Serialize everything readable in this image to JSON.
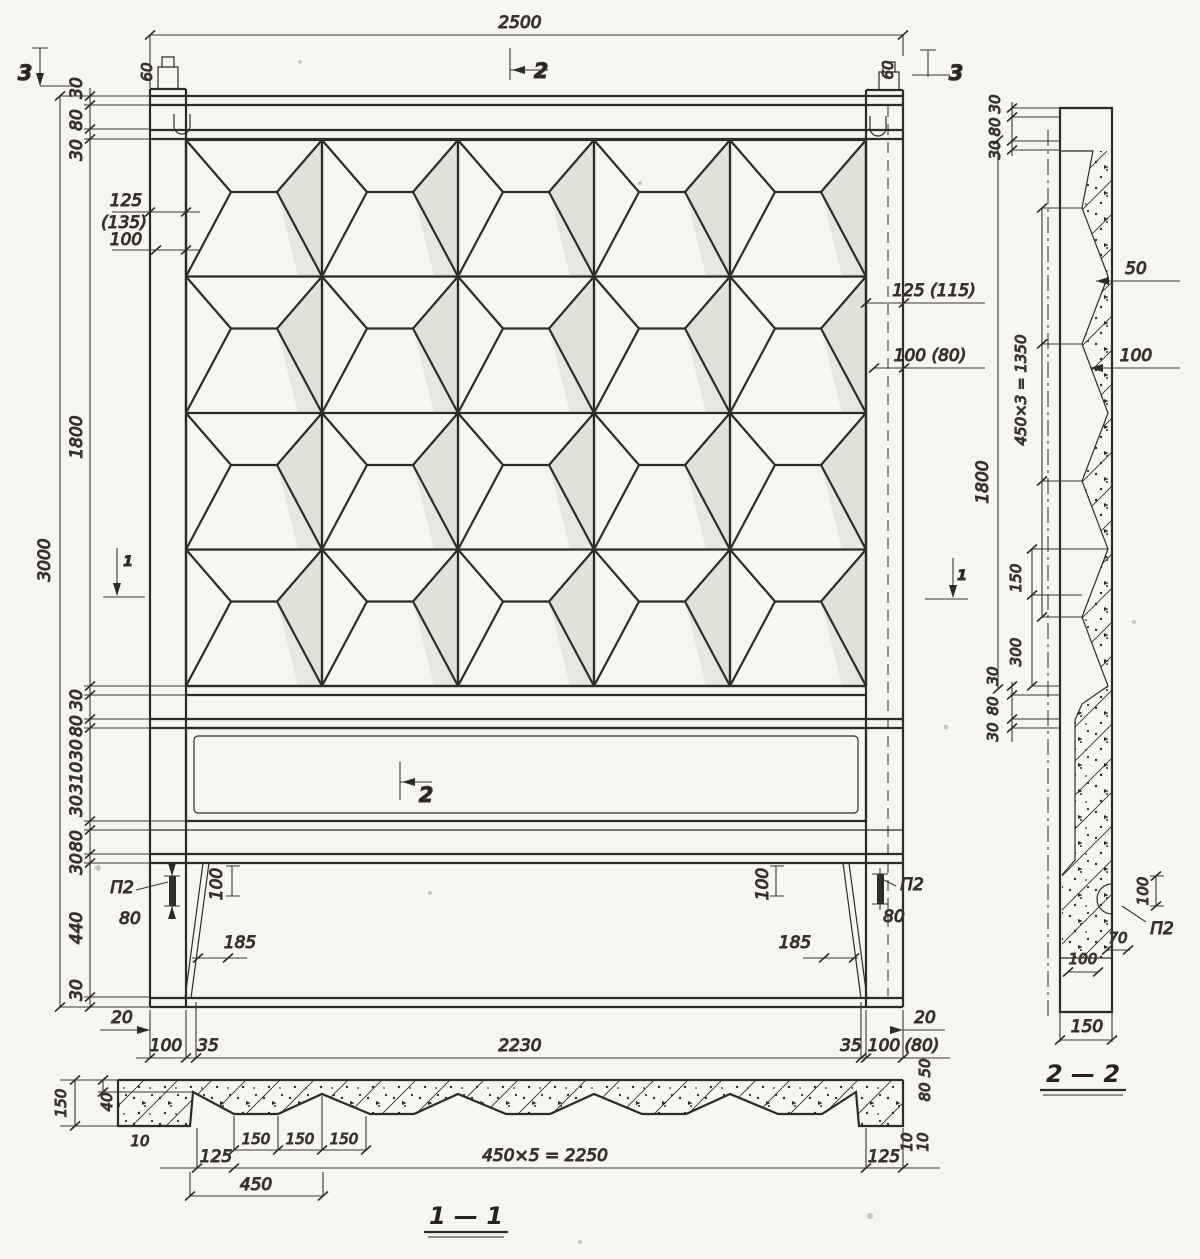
{
  "drawing": {
    "section_labels": {
      "s11": "1 — 1",
      "s22": "2 — 2"
    },
    "markers": {
      "m1": "1",
      "m2": "2",
      "m3": "3"
    },
    "callouts": {
      "p2": "П2"
    },
    "dims": {
      "d2500": "2500",
      "d3000": "3000",
      "d1800": "1800",
      "d30": "30",
      "d80": "80",
      "d60": "60",
      "d20": "20",
      "d35": "35",
      "d50": "50",
      "d70": "70",
      "d10": "10",
      "d40": "40",
      "d100": "100",
      "d125": "125",
      "d135alt": "(135)",
      "d150": "150",
      "d185": "185",
      "d300": "300",
      "d310": "310",
      "d440": "440",
      "d80alt": "(80)",
      "d125alt": "125 (115)",
      "d100alt": "100 (80)",
      "d450": "450",
      "d450x3": "450×3 = 1350",
      "d450x5": "450×5 = 2250",
      "d2230": "2230"
    }
  }
}
